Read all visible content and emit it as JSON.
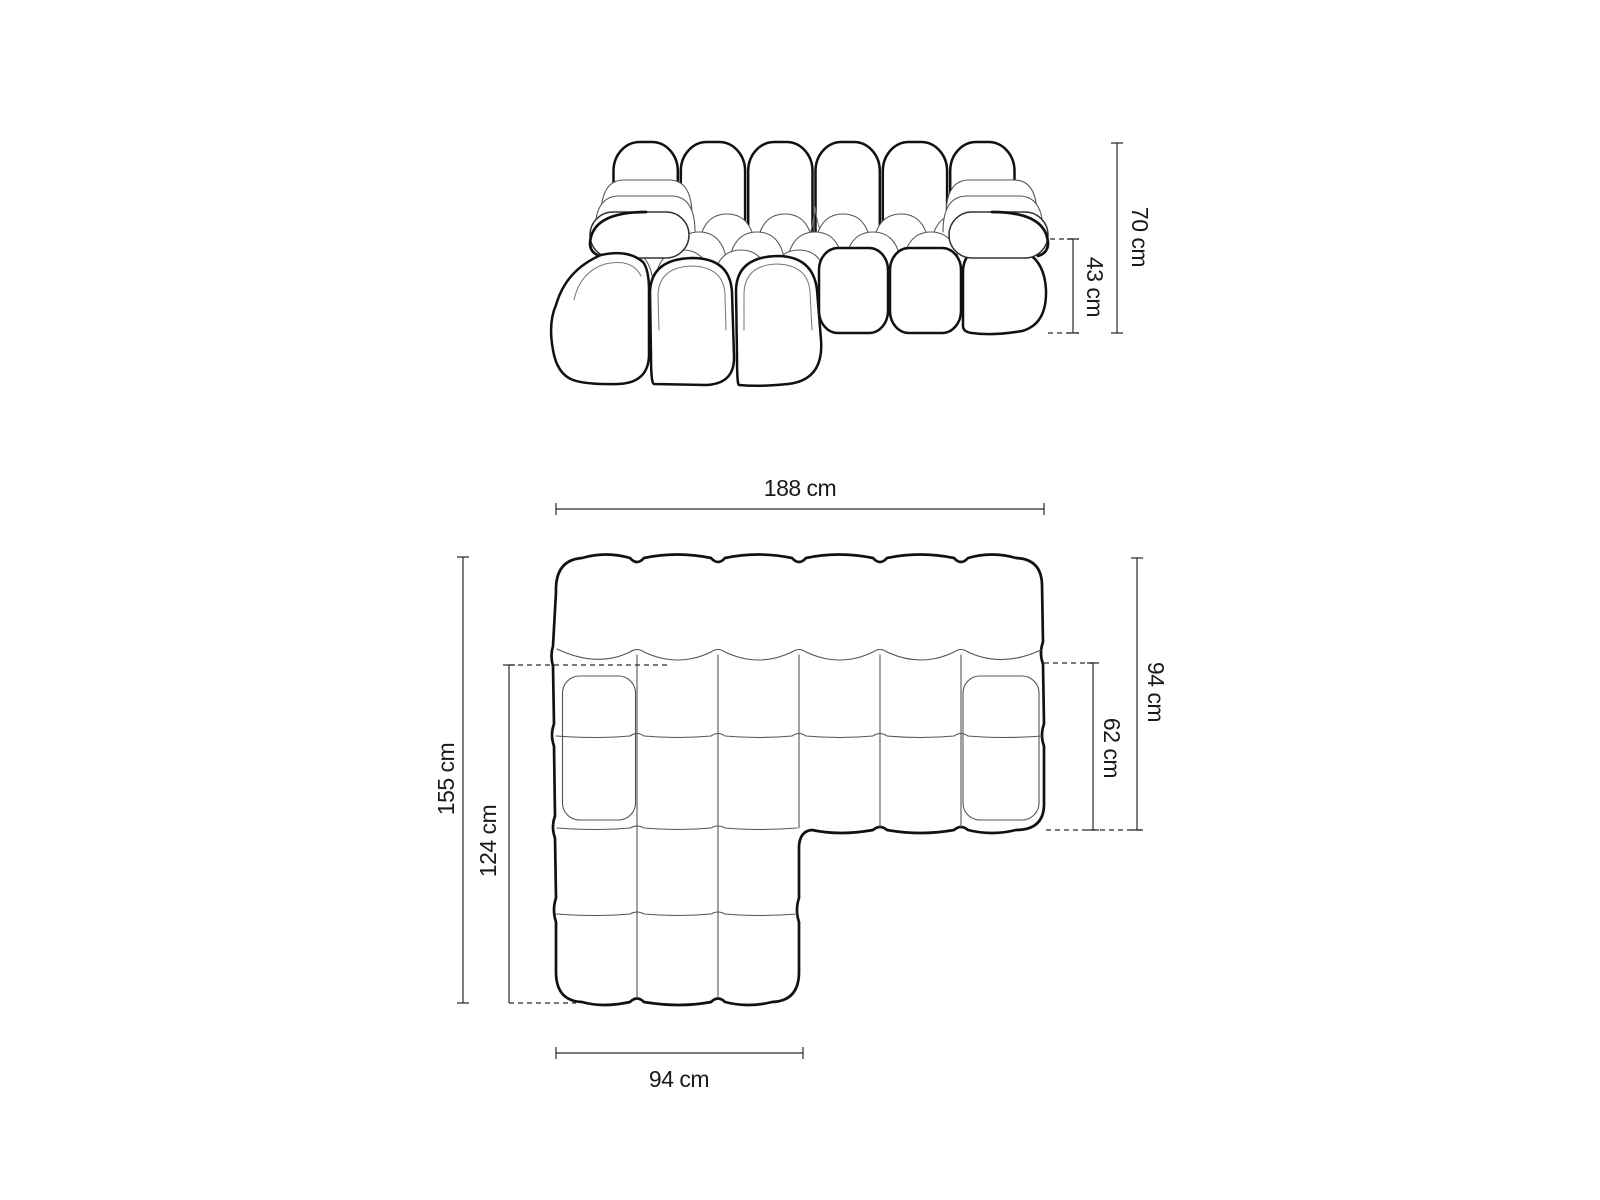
{
  "style": {
    "background": "#ffffff",
    "outline_color": "#111111",
    "seam_color": "#555555",
    "dimension_color": "#2a2a2a",
    "label_color": "#1a1a1a"
  },
  "front_view": {
    "total_height": "70 cm",
    "seat_height": "43 cm"
  },
  "top_view": {
    "total_width": "188 cm",
    "total_depth": "155 cm",
    "chaise_depth": "124 cm",
    "body_depth": "94 cm",
    "seat_depth": "62 cm",
    "chaise_width": "94 cm"
  }
}
